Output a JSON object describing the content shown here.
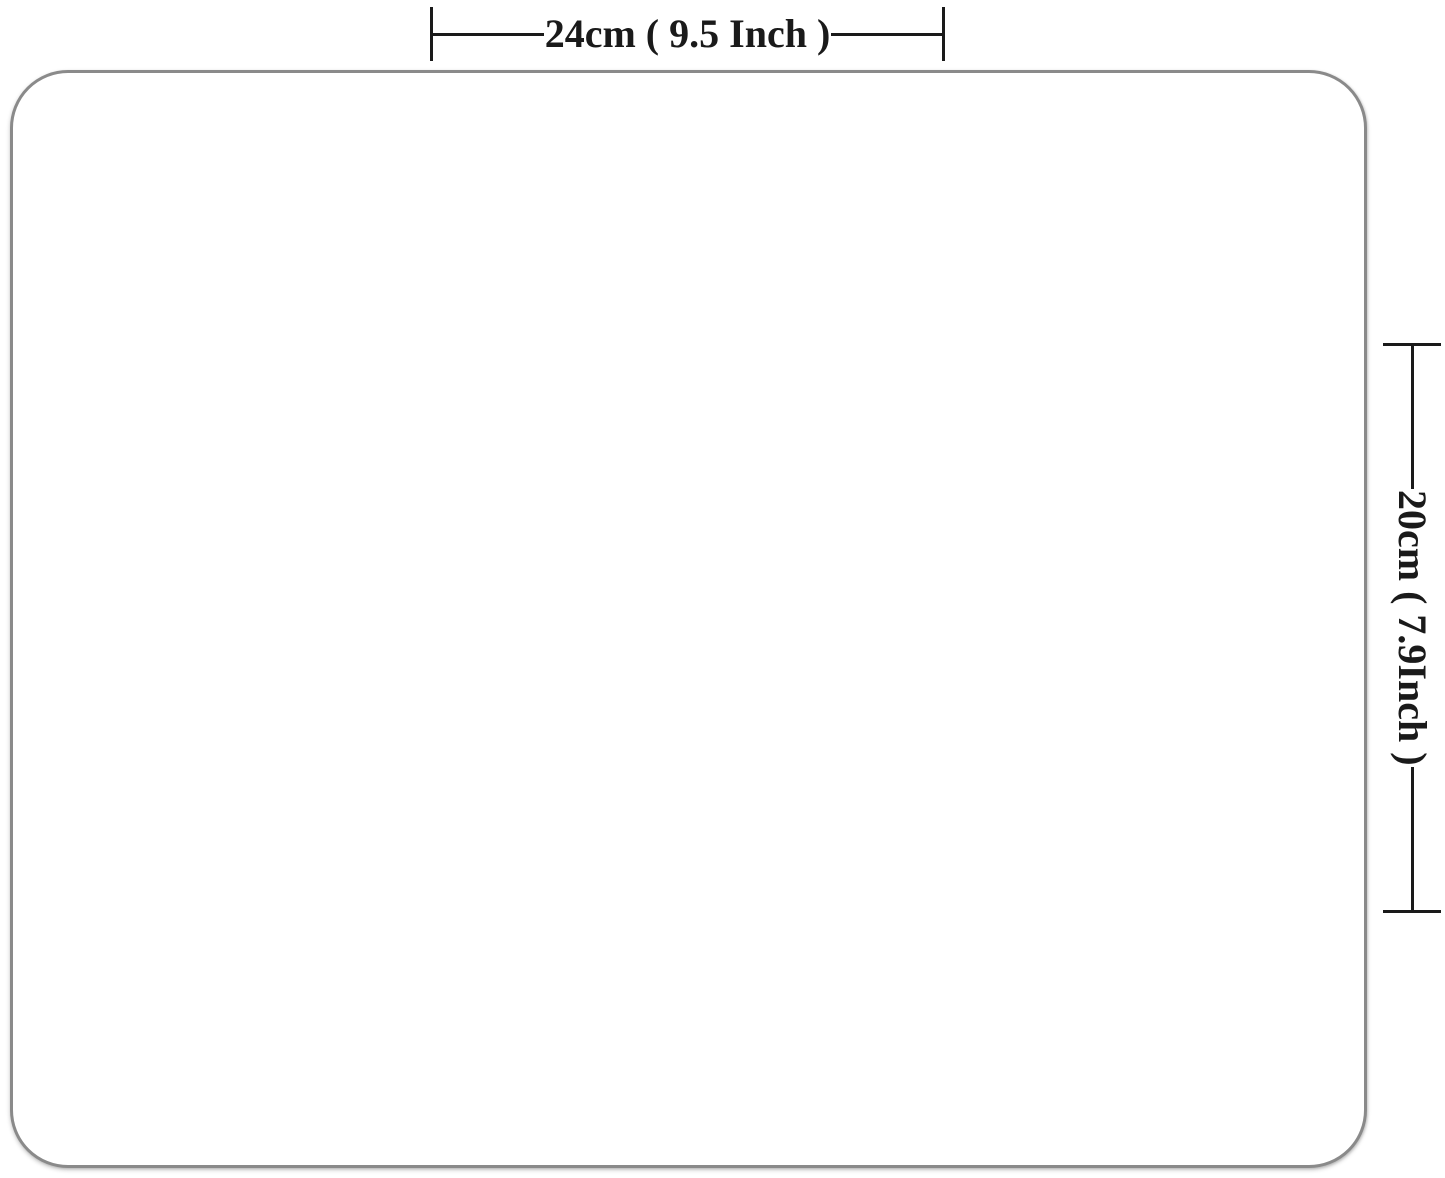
{
  "diagram": {
    "type": "product-dimension-diagram",
    "width_label": "24cm ( 9.5 Inch )",
    "height_label": "20cm ( 7.9Inch )"
  },
  "colors": {
    "line": "#1a1a1a",
    "pad_border": "#8a8a8a",
    "pad_fill": "#ffffff",
    "background": "#ffffff"
  }
}
